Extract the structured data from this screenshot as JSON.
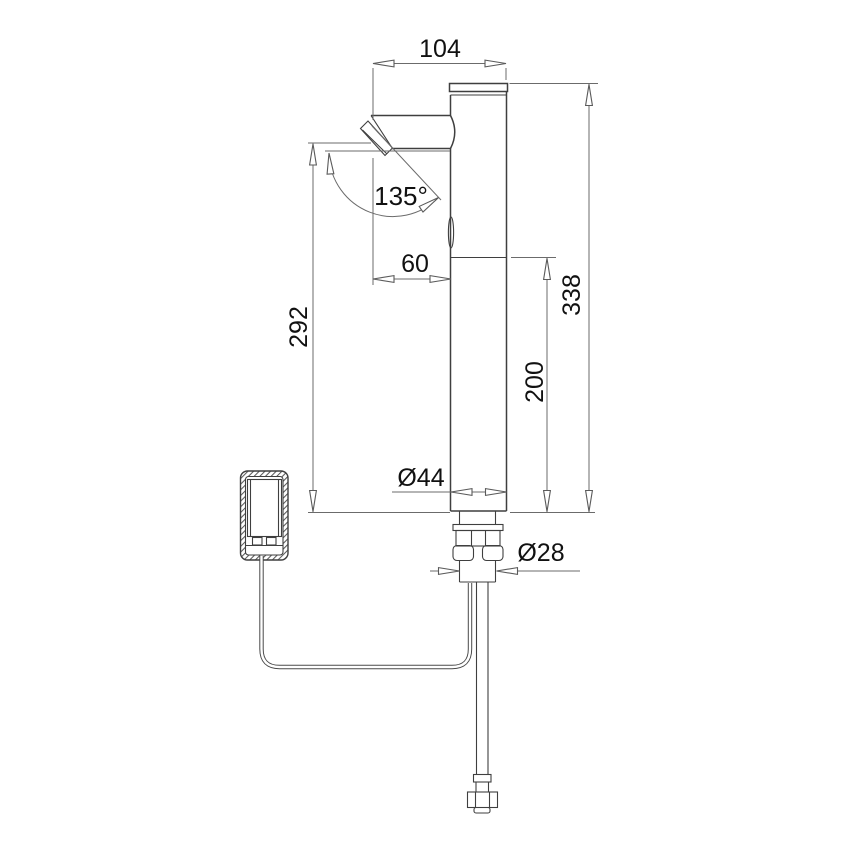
{
  "page": {
    "background": "#ffffff",
    "object_line_color": "#3f3f3f",
    "dimension_line_color": "#6b6b6b",
    "text_color": "#111111"
  },
  "drawing": {
    "type": "faucet-installation-dimension-drawing",
    "labels": {
      "top_width": "104",
      "aerator_angle": "135°",
      "spout_overhang": "60",
      "outlet_height": "292",
      "total_height": "338",
      "sensor_height": "200",
      "body_diameter": "Ø44",
      "shank_diameter": "Ø28"
    }
  }
}
